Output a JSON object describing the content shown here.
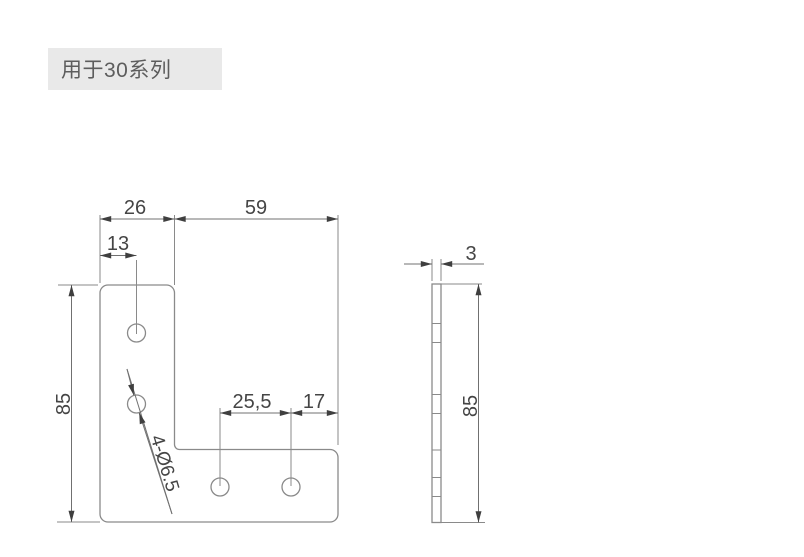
{
  "series_label": {
    "text": "用于30系列"
  },
  "colors": {
    "background": "#ffffff",
    "label_background": "#e9e9e9",
    "label_text": "#5d5d5d",
    "drawing_lines": "#8a8a8a",
    "dimension_lines": "#707070",
    "dimension_text": "#454545"
  },
  "front_view": {
    "dim_arm_width": "26",
    "dim_remaining_width": "59",
    "dim_hole_offset": "13",
    "dim_height": "85",
    "dim_hole_spacing": "25,5",
    "dim_hole_to_edge": "17",
    "hole_callout": "4-Ø6.5"
  },
  "side_view": {
    "dim_thickness": "3",
    "dim_height": "85"
  }
}
